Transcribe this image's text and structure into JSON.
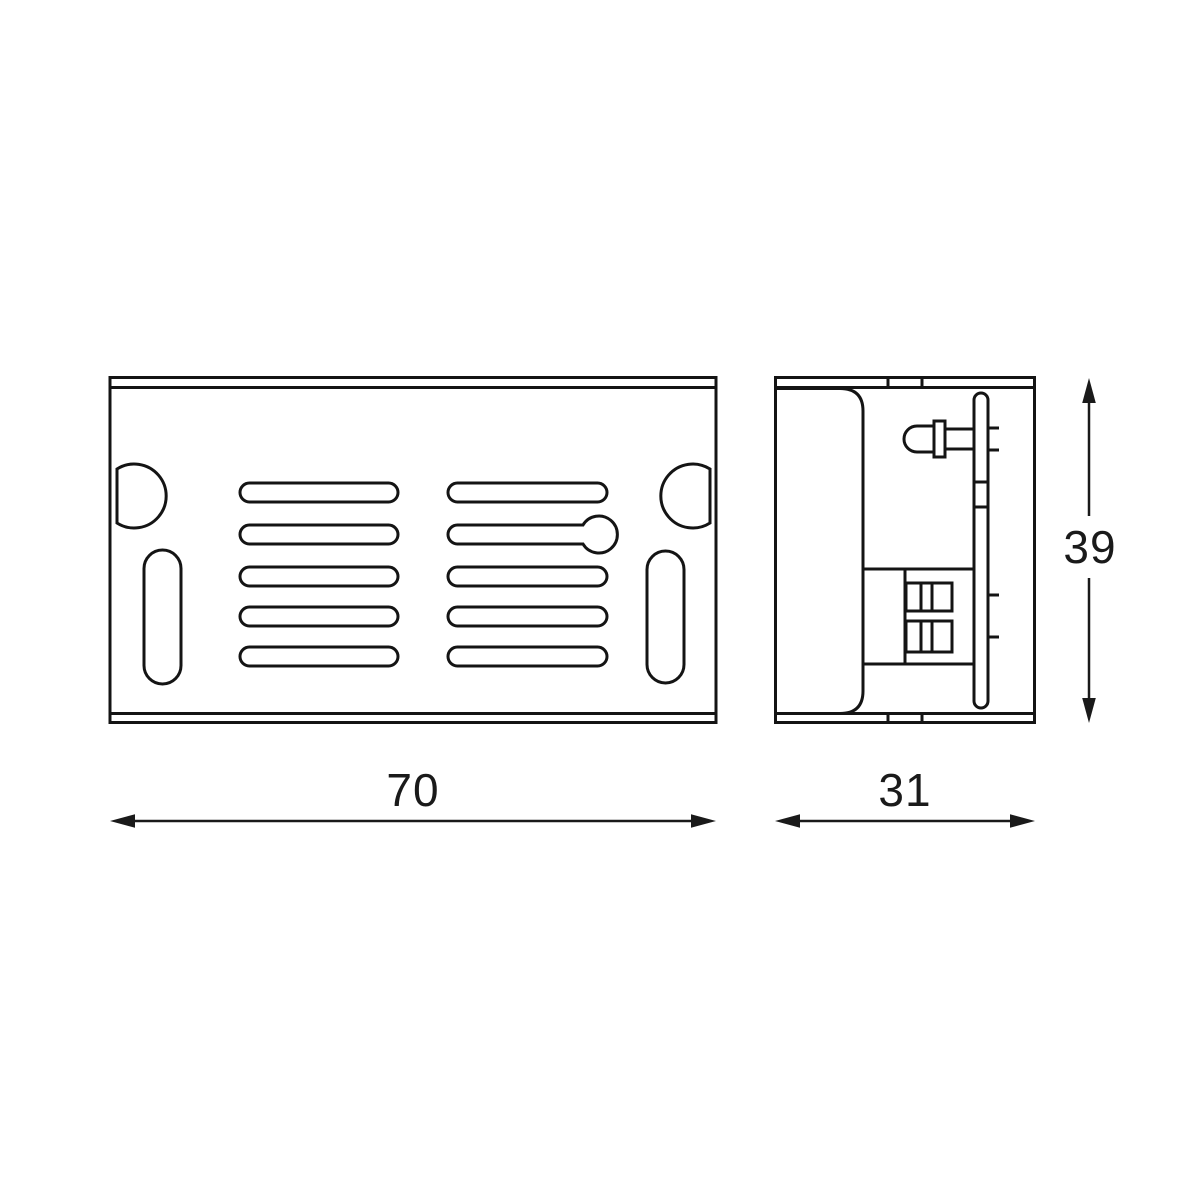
{
  "canvas": {
    "background": "#ffffff",
    "line_color": "#141414"
  },
  "views": {
    "front": {
      "vent_slot_rows": 5,
      "vent_slot_columns": 2,
      "dimension_width": {
        "value": "70"
      }
    },
    "side": {
      "dimension_depth": {
        "value": "31"
      },
      "dimension_height": {
        "value": "39"
      }
    }
  }
}
